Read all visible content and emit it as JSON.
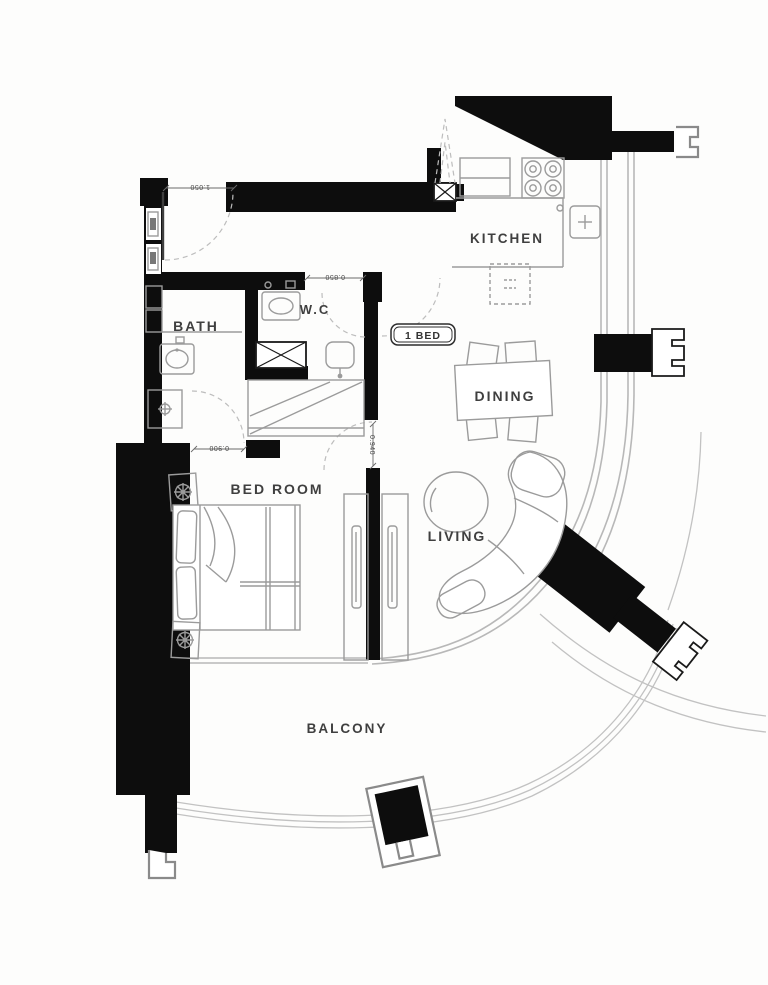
{
  "plan": {
    "badge": "1 BED",
    "labels": {
      "kitchen": "KITCHEN",
      "dining": "DINING",
      "living": "LIVING",
      "bedroom": "BED ROOM",
      "bath": "BATH",
      "wc": "W.C",
      "balcony": "BALCONY"
    },
    "dimensions": {
      "entry": "1.050",
      "wc": "0.850",
      "bath": "0.900",
      "bedroom": "0.940"
    },
    "colors": {
      "wall": "#0d0d0d",
      "furniture_line": "#9b9b9b",
      "glass_line": "#b8b8b8",
      "label_text": "#3f3f3f",
      "dim_text": "#4a4a4a",
      "background": "#fdfdfc"
    }
  }
}
